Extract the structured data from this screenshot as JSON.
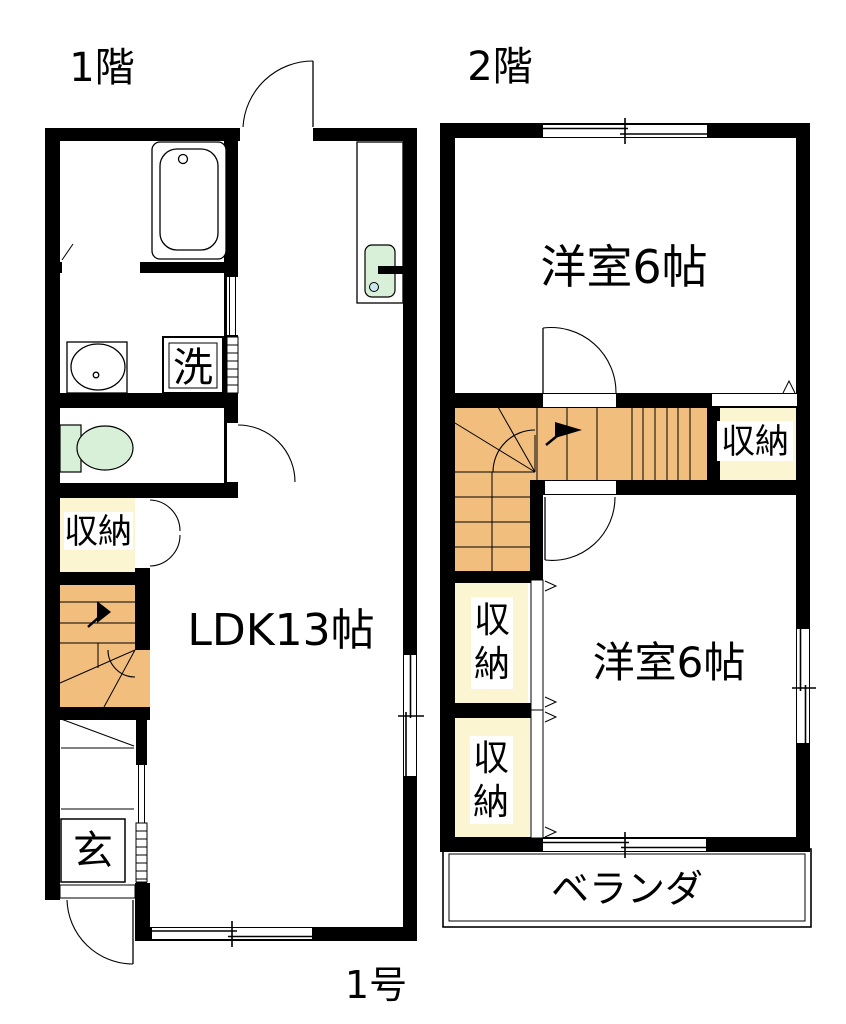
{
  "plan": {
    "floor1": {
      "title": "1階",
      "unit_label": "1号",
      "ldk_label": "LDK13帖",
      "laundry_label": "洗",
      "entrance_label": "玄",
      "closet_label": "収納"
    },
    "floor2": {
      "title": "2階",
      "bedroom_north_label": "洋室6帖",
      "bedroom_south_label": "洋室6帖",
      "closet_upper_label": "収納",
      "closet_mid_label": "収納",
      "closet_lower_label": "収納",
      "veranda_label": "ベランダ"
    },
    "colors": {
      "wall": "#000000",
      "stairs": "#F1BE7E",
      "closet": "#FBF5D1",
      "fixture_green": "#D8F0D8",
      "drain_blue": "#C9E8F0"
    }
  }
}
